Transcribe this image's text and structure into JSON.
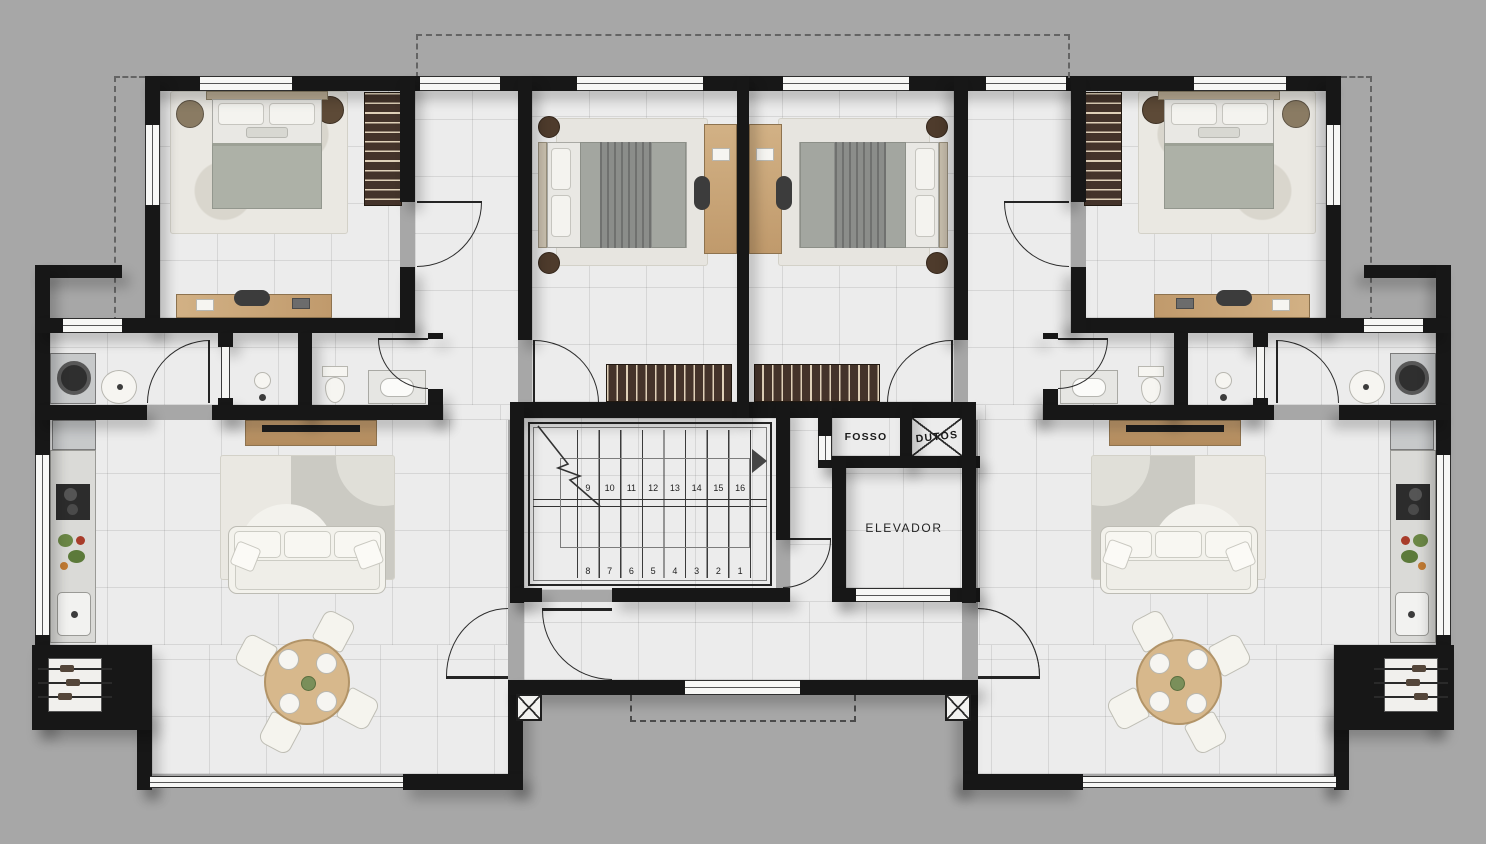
{
  "scene": {
    "type": "architectural-floor-plan",
    "description": "Top-view residential floor plan: two mirrored apartments flanking a central stair and elevator core",
    "visible_rooms": [
      "bedroom",
      "bedroom",
      "bathrooms",
      "laundry",
      "living-dining",
      "kitchen",
      "barbecue-corner",
      "stair-hall"
    ]
  },
  "labels": {
    "fosso": "FOSSO",
    "dutos": "DUTOS",
    "elevator": "ELEVADOR"
  },
  "stairs": {
    "upper_flight_numbers": [
      "9",
      "10",
      "11",
      "12",
      "13",
      "14",
      "15",
      "16"
    ],
    "lower_flight_numbers": [
      "8",
      "7",
      "6",
      "5",
      "4",
      "3",
      "2",
      "1"
    ]
  },
  "palette": {
    "exterior_gray": "#a7a7a7",
    "floor": "#ececec",
    "wall_black": "#171717",
    "wood_light": "#c8a87c",
    "wood_console": "#bb9468",
    "wardrobe_dark": "#44332a",
    "wardrobe_stripe": "#e4d5ba",
    "fabric_white": "#f6f5f1",
    "duvet_gray_green": "#adb1a7",
    "rug_light": "#eae8e2",
    "rug_dark": "#c9c8c1",
    "appliance_gray": "#c7c9ca",
    "greens": "#6b8746",
    "produce_red": "#a83c2a"
  },
  "icons": [
    "double-bed",
    "pillow",
    "wardrobe",
    "desk",
    "office-chair",
    "nightstand",
    "washing-machine",
    "laundry-sink",
    "shower",
    "toilet",
    "vanity-sink",
    "sofa",
    "tv-console",
    "area-rug",
    "dining-table",
    "dining-chair",
    "kitchen-counter",
    "fridge",
    "cooktop",
    "kitchen-sink",
    "barbecue-grill",
    "door-swing",
    "window",
    "stair-treads",
    "direction-arrow",
    "break-line",
    "column-marker",
    "elevator-door"
  ]
}
